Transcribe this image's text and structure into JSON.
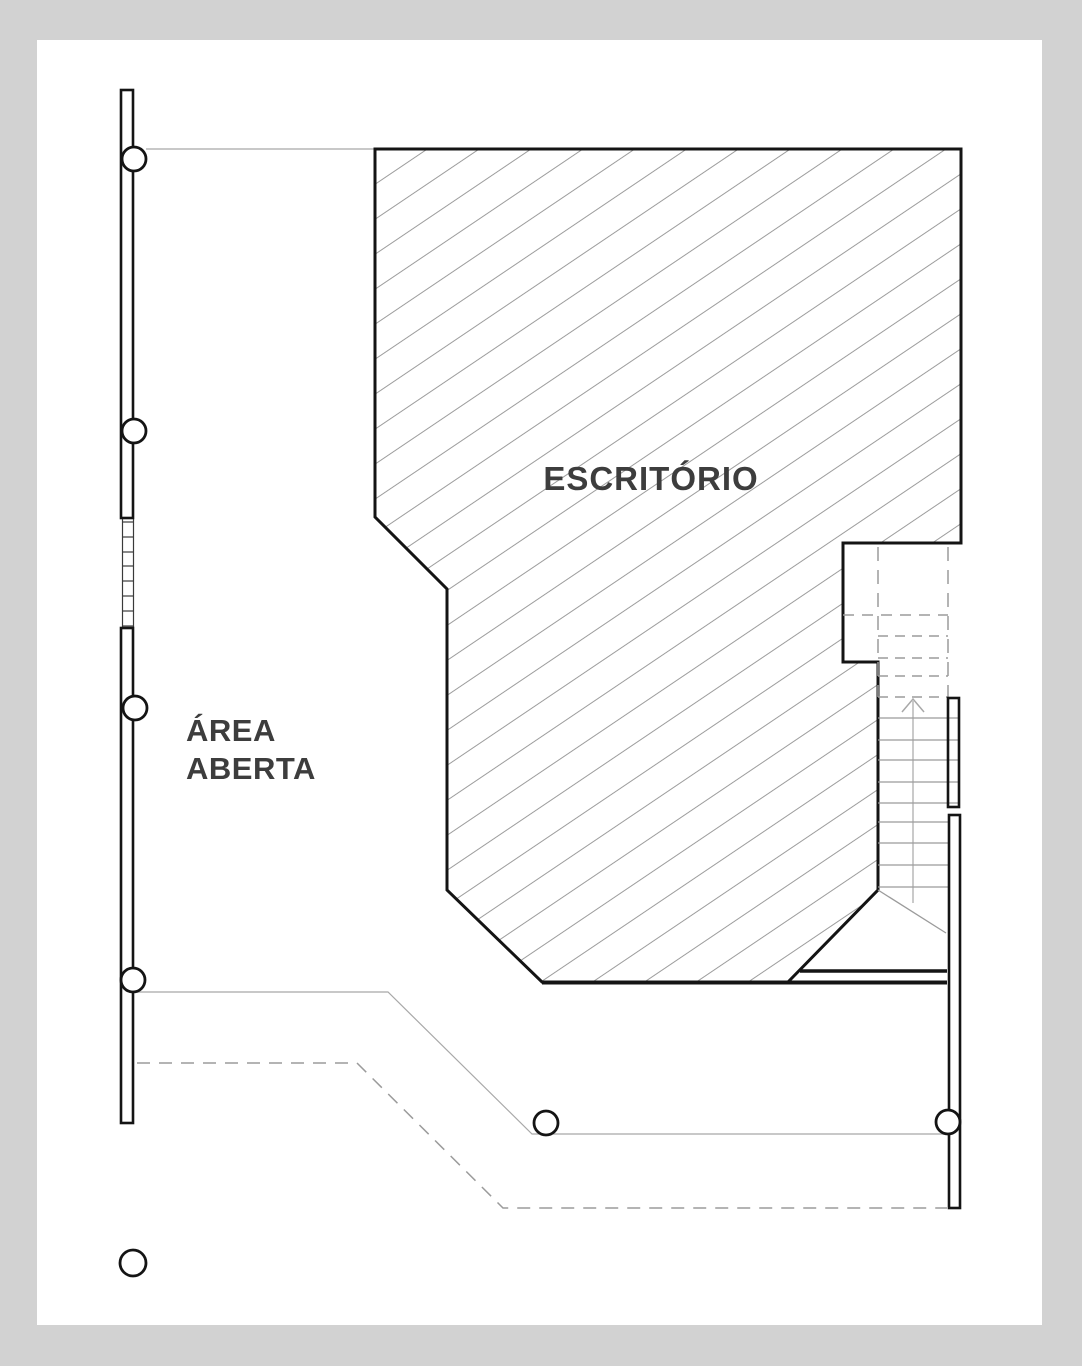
{
  "plan": {
    "rooms": [
      {
        "id": "escritorio",
        "label": "ESCRITÓRIO"
      },
      {
        "id": "area-aberta",
        "label": "ÁREA ABERTA",
        "label_lines": [
          "ÁREA",
          "ABERTA"
        ]
      }
    ],
    "features": {
      "column_count": 7,
      "stair_direction": "up"
    }
  },
  "colors": {
    "canvas_background": "#d2d2d2",
    "page": "#ffffff",
    "wall_line": "#141414",
    "hatch_line": "#9c9c9c",
    "guide_line": "#a8a8a8",
    "dashed_line": "#9b9b9b",
    "label_text": "#3d3d3d"
  }
}
